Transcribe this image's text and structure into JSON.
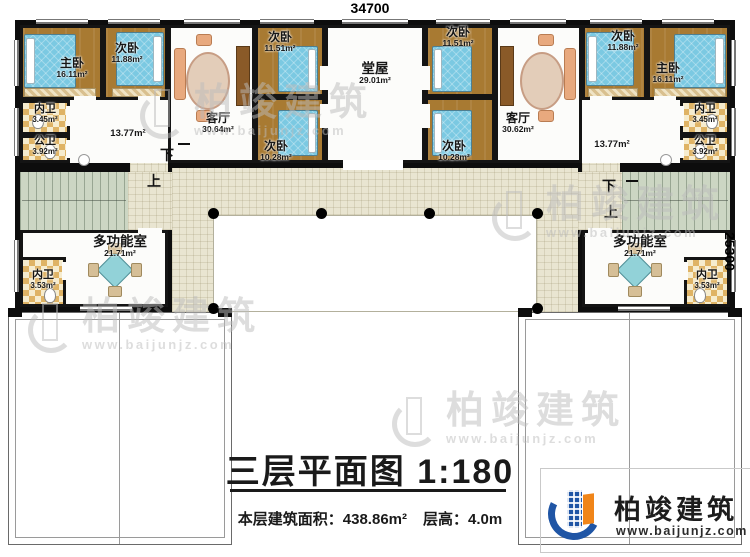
{
  "document": {
    "dim_width": "34700",
    "dim_height": "25300",
    "title": "三层平面图",
    "scale": "1:180",
    "floor_area_label": "本层建筑面积：438.86m²",
    "floor_height_label": "层高：4.0m"
  },
  "brand": {
    "name": "柏竣建筑",
    "url": "www.baijunjz.com"
  },
  "watermark": {
    "name": "柏竣建筑",
    "url": "www.baijunjz.com"
  },
  "stairs": {
    "up": "上",
    "down": "下"
  },
  "rooms": {
    "master_left": {
      "label": "主卧",
      "area": "16.11m²"
    },
    "second_left": {
      "label": "次卧",
      "area": "11.88m²"
    },
    "inner_bath_left": {
      "label": "内卫",
      "area": "3.45m²"
    },
    "public_bath_left": {
      "label": "公卫",
      "area": "3.92m²"
    },
    "living_left": {
      "label": "客厅",
      "area": "30.64m²"
    },
    "corridor_left": {
      "area": "13.77m²"
    },
    "second_mid_left_upper": {
      "label": "次卧",
      "area": "11.51m²"
    },
    "second_mid_left_lower": {
      "label": "次卧",
      "area": "10.28m²"
    },
    "main_hall": {
      "label": "堂屋",
      "area": "29.01m²"
    },
    "second_mid_right_upper": {
      "label": "次卧",
      "area": "11.51m²"
    },
    "second_mid_right_lower": {
      "label": "次卧",
      "area": "10.28m²"
    },
    "living_right": {
      "label": "客厅",
      "area": "30.62m²"
    },
    "second_right": {
      "label": "次卧",
      "area": "11.88m²"
    },
    "master_right": {
      "label": "主卧",
      "area": "16.11m²"
    },
    "inner_bath_right": {
      "label": "内卫",
      "area": "3.45m²"
    },
    "public_bath_right": {
      "label": "公卫",
      "area": "3.92m²"
    },
    "corridor_right": {
      "area": "13.77m²"
    },
    "multi_left": {
      "label": "多功能室",
      "area": "21.71m²"
    },
    "multi_bath_left": {
      "label": "内卫",
      "area": "3.53m²"
    },
    "multi_right": {
      "label": "多功能室",
      "area": "21.71m²"
    },
    "multi_bath_right": {
      "label": "内卫",
      "area": "3.53m²"
    }
  },
  "colors": {
    "wall": "#0d0d0d",
    "wood_floor": "#a87a32",
    "bed": "#7bc9e2",
    "bath_tile": "#dfb365",
    "courtyard": "#e9e5d1",
    "stairs": "#ccd6c3",
    "brand_blue": "#1f55a5",
    "brand_orange": "#f08519",
    "watermark_gray": "#bcbcbc"
  }
}
